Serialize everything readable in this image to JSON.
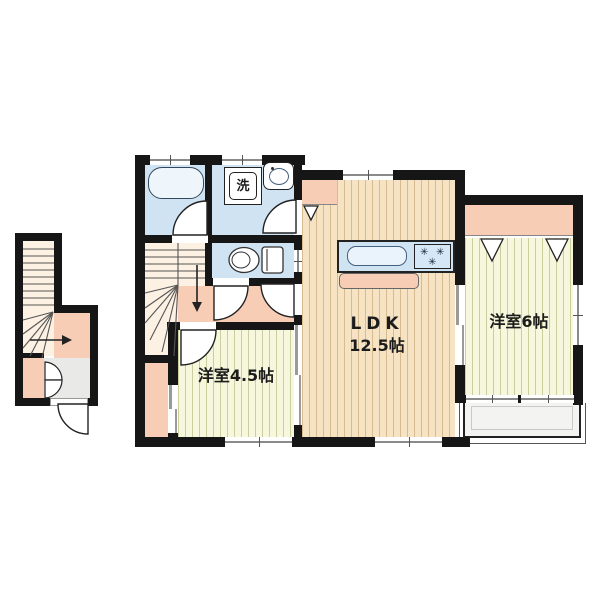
{
  "plan": {
    "labels": {
      "ldk_name": "LDK",
      "ldk_size": "12.5帖",
      "bedroom_small": "洋室4.5帖",
      "bedroom_large": "洋室6帖",
      "washing_machine": "洗",
      "burner": "✳"
    },
    "colors": {
      "wall": "#161616",
      "wet_area": "#cfe3f2",
      "wood_floor": "#f5e3c4",
      "tatami_floor": "#f6f7dc",
      "closet": "#f8cdb5",
      "stairs": "#fdf1e3",
      "balcony": "#f3f3f1",
      "entrance": "#e9e9e7"
    }
  }
}
